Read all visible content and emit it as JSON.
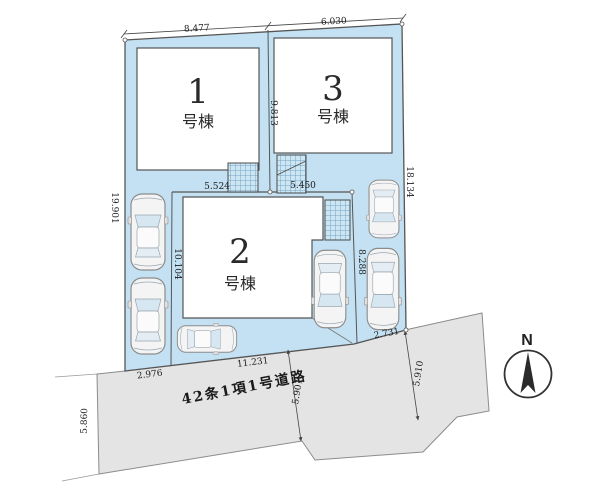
{
  "plan": {
    "buildings": [
      {
        "number": "1",
        "label": "号棟"
      },
      {
        "number": "2",
        "label": "号棟"
      },
      {
        "number": "3",
        "label": "号棟"
      }
    ],
    "dimensions": {
      "top_left": "8.477",
      "top_right": "6.030",
      "between_1_3": "9.813",
      "left_edge": "19.901",
      "lot2_left": "10.104",
      "right_edge": "18.134",
      "lot2_top_left": "5.524",
      "lot2_top_right": "5.450",
      "lot2_right": "8.288",
      "frontage_left": "2.976",
      "frontage_center": "11.231",
      "frontage_right": "2.731",
      "road_width_left": "5.860",
      "road_width_center": "5.901",
      "road_width_right": "5.910"
    },
    "road": {
      "label": "42条1項1号道路"
    },
    "compass": {
      "label": "N"
    },
    "colors": {
      "land": "#c3e1f2",
      "road": "#e4e4e4",
      "outline": "#555555",
      "building": "#ffffff"
    }
  }
}
